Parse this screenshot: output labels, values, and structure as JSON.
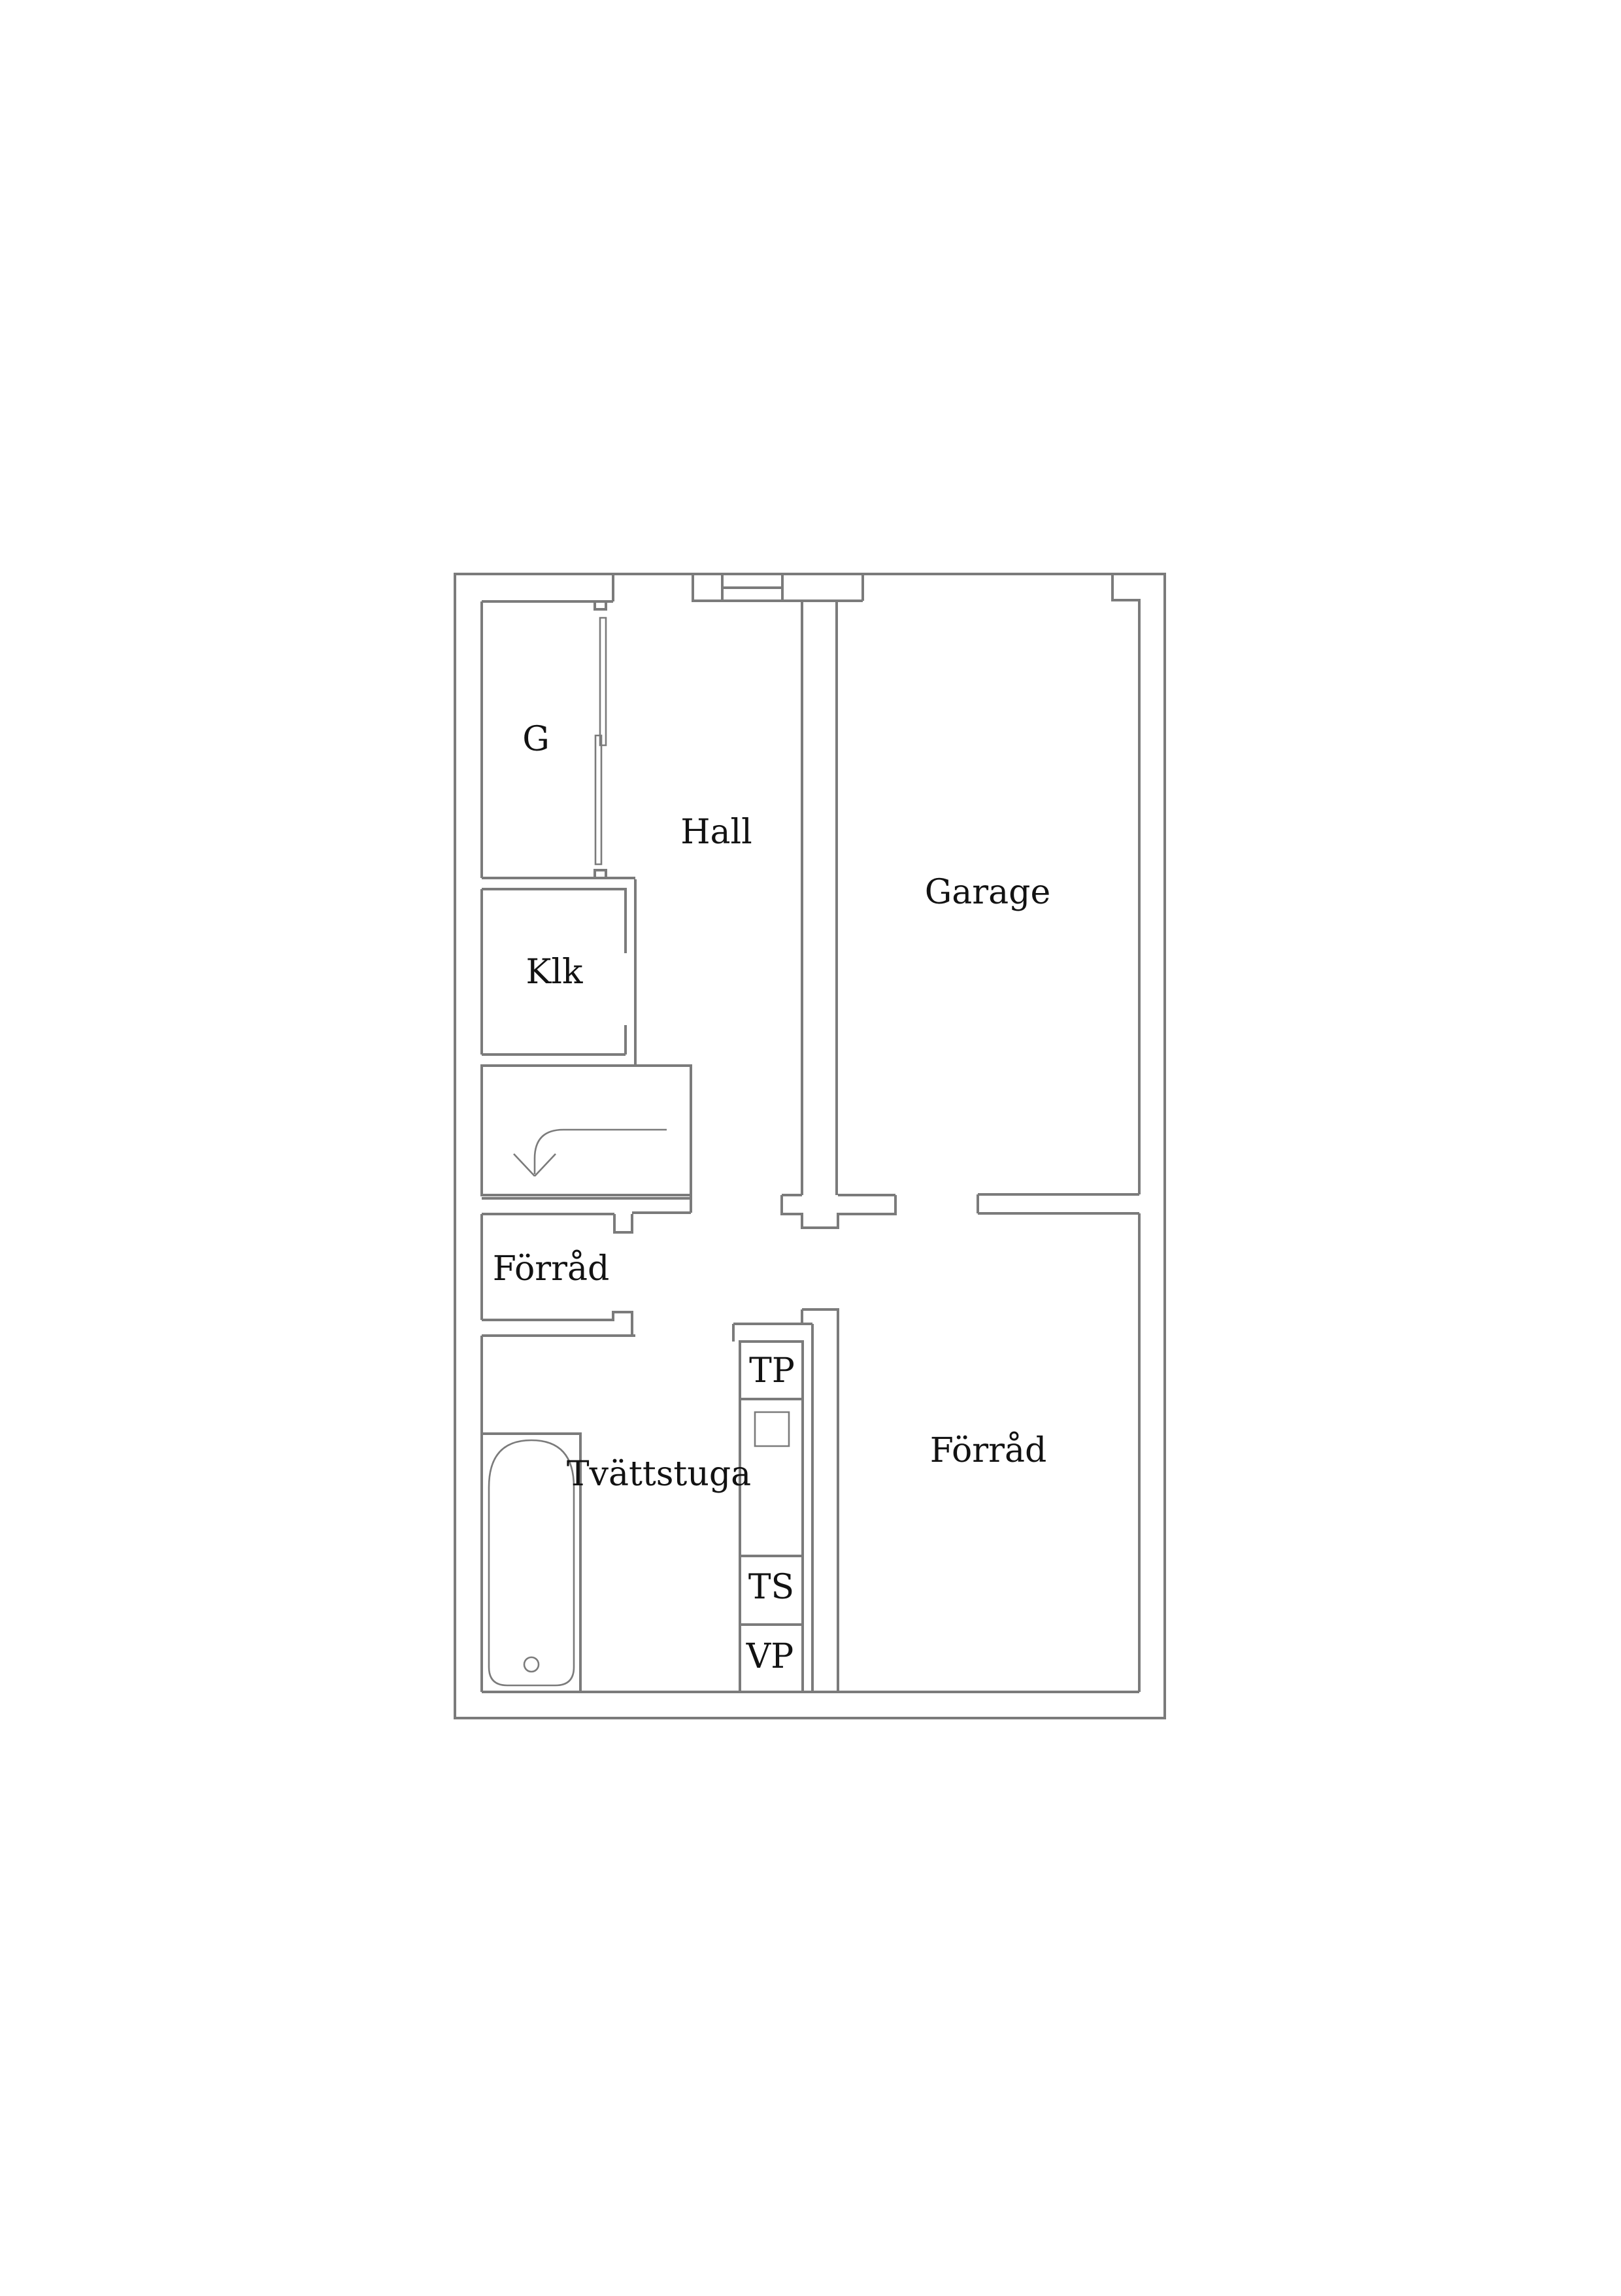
{
  "floorplan": {
    "background": "#ffffff",
    "wall_color": "#7b7b7b",
    "label_color": "#121212",
    "labels": {
      "g": "G",
      "hall": "Hall",
      "garage": "Garage",
      "klk": "Klk",
      "forrad_left": "Förråd",
      "tvattstuga": "Tvättstuga",
      "forrad_right": "Förråd",
      "tp": "TP",
      "ts": "TS",
      "vp": "VP"
    },
    "fixtures": [
      "bathtub-icon",
      "bathtub-drain-icon",
      "sliding-closet-doors-icon",
      "staircase-down-arrow-icon",
      "washing-machine-square-icon"
    ]
  }
}
